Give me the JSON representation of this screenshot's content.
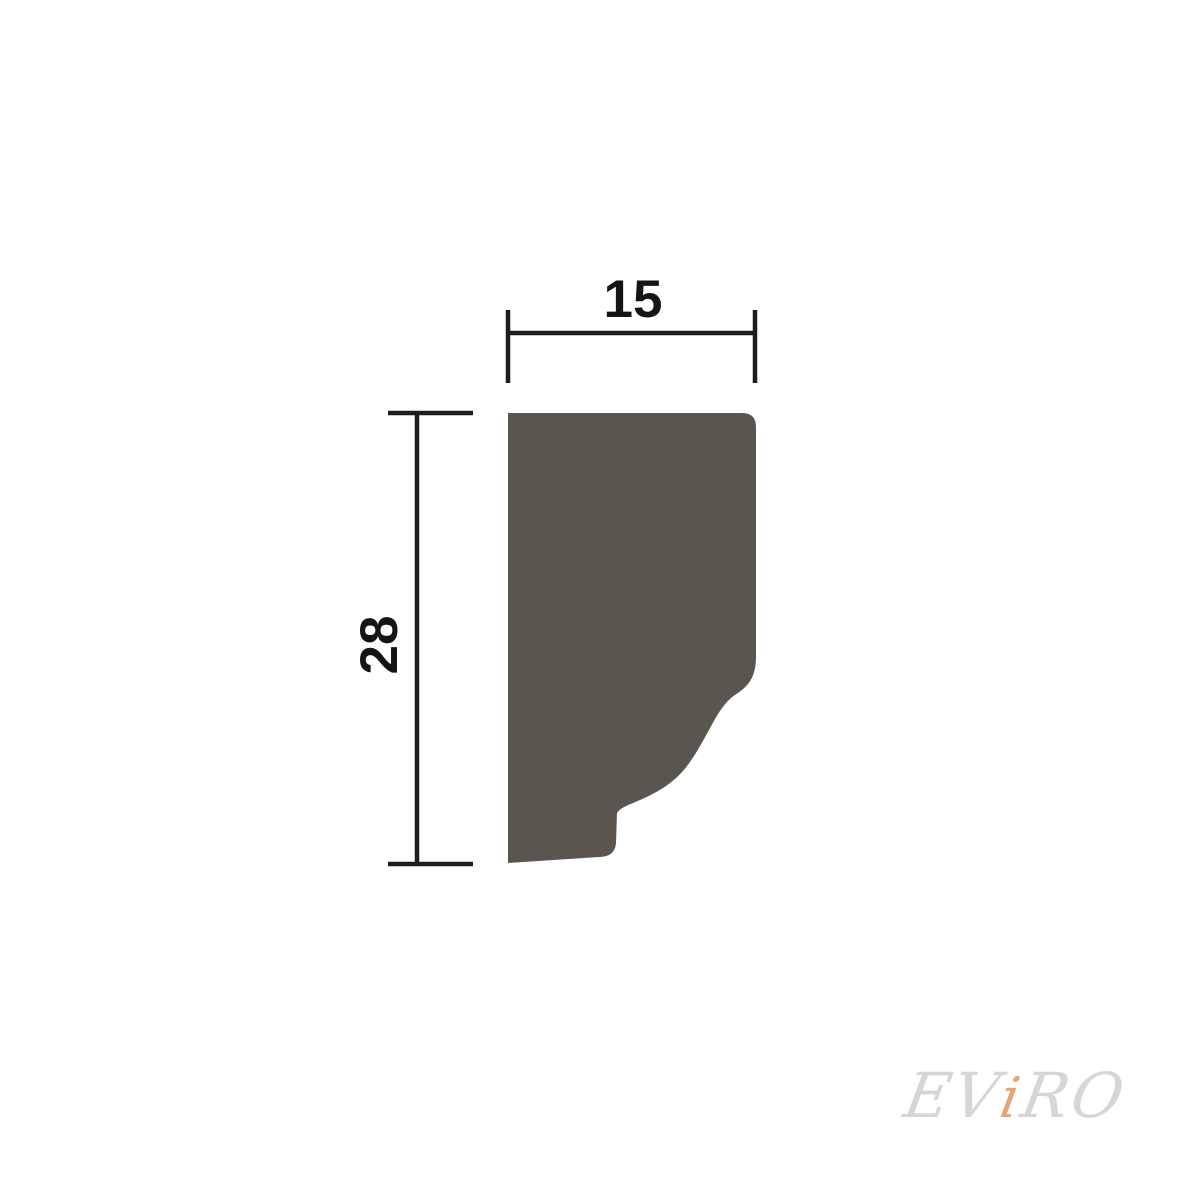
{
  "drawing": {
    "description": "Molding profile cross-section technical drawing",
    "shape": {
      "name": "molding-profile",
      "fill": "#5a564f"
    },
    "dim_line_color": "#1d1d1d",
    "width_dim": {
      "label": "15"
    },
    "height_dim": {
      "label": "28"
    }
  },
  "watermark": {
    "prefix": "EV",
    "accent": "i",
    "suffix": "RO",
    "text_color": "#d6d6d8",
    "accent_color": "#e8a474"
  }
}
